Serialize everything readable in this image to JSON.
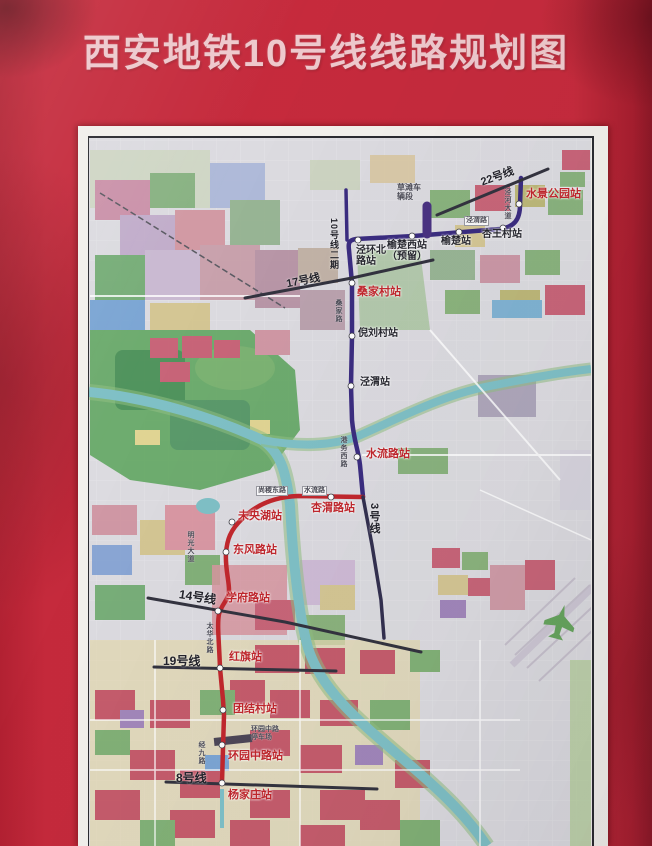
{
  "poster": {
    "title": "西安地铁10号线线路规划图"
  },
  "map": {
    "title": "西安市地铁十号线一期工程（杨家庄～水景公园）线路平面示意图",
    "colors": {
      "line10_north": "#3b2c80",
      "line10_south": "#c1272d",
      "other_lines": "#33333f",
      "station_label_red": "#c1272d",
      "station_label_black": "#26262e",
      "river": "#7fc0c6",
      "poster_background": "#c52a3c"
    },
    "lines": [
      {
        "id": "line10-north",
        "label": "10号线一期北段",
        "color": "#3b2c80",
        "width": 4.5,
        "d": "M521,178 L520,205 C520,220 514,227 500,229 L414,236 L356,239 C349,240 348,243 349,250 L352,283 L352,336 L351,386 L352,420 C354,442 358,448 360,465 L363,497"
      },
      {
        "id": "line10-phase2",
        "label": "10号线二期",
        "color": "#3b2c80",
        "width": 3.5,
        "d": "M346,190 L347,240"
      },
      {
        "id": "depot-spur",
        "label": "车辆段出入线",
        "color": "#4a3382",
        "width": 9,
        "d": "M427,206 L427,234"
      },
      {
        "id": "line10-south",
        "label": "10号线一期南段",
        "color": "#c1272d",
        "width": 4.5,
        "d": "M363,497 L298,496 C272,497 255,506 243,518 C230,530 227,540 226,553 C225,568 229,580 229,590 C229,600 222,603 219,614 C217,625 219,640 220,668 L223,700 L224,715 L223,748 L222,783"
      },
      {
        "id": "line-22",
        "label": "22号线",
        "color": "#33333f",
        "width": 3,
        "d": "M437,215 L548,169"
      },
      {
        "id": "line-17",
        "label": "17号线",
        "color": "#33333f",
        "width": 3,
        "d": "M245,298 L352,278 L433,260"
      },
      {
        "id": "line-3",
        "label": "3号线",
        "color": "#33304f",
        "width": 3.5,
        "d": "M363,497 L372,545 L381,600 L384,638"
      },
      {
        "id": "line-14",
        "label": "14号线",
        "color": "#33333f",
        "width": 3,
        "d": "M148,598 L285,622 L421,652"
      },
      {
        "id": "line-19",
        "label": "19号线",
        "color": "#33333f",
        "width": 3,
        "d": "M154,667 L336,671"
      },
      {
        "id": "line-8",
        "label": "8号线",
        "color": "#33333f",
        "width": 3,
        "d": "M166,782 L377,789"
      }
    ],
    "stations": [
      {
        "name": "水景公园站",
        "x": 519,
        "y": 204,
        "lx": 526,
        "ly": 189,
        "color": "red"
      },
      {
        "name": "杏王村站",
        "x": 503,
        "y": 228,
        "lx": 482,
        "ly": 230,
        "color": "black"
      },
      {
        "name": "榆楚站",
        "x": 459,
        "y": 232,
        "lx": 441,
        "ly": 237,
        "color": "black"
      },
      {
        "name": "榆楚西站（预留）",
        "lines": [
          "榆楚西站",
          "（预留）"
        ],
        "x": 412,
        "y": 236,
        "lx": 387,
        "ly": 241,
        "color": "black"
      },
      {
        "name": "泾环北路站",
        "lines": [
          "泾环北",
          "路站"
        ],
        "x": 358,
        "y": 240,
        "lx": 356,
        "ly": 246,
        "color": "black"
      },
      {
        "name": "桑家村站",
        "x": 352,
        "y": 283,
        "lx": 357,
        "ly": 287,
        "color": "red"
      },
      {
        "name": "倪刘村站",
        "x": 352,
        "y": 336,
        "lx": 358,
        "ly": 329,
        "color": "black"
      },
      {
        "name": "泾渭站",
        "x": 351,
        "y": 386,
        "lx": 360,
        "ly": 378,
        "color": "black"
      },
      {
        "name": "水流路站",
        "x": 357,
        "y": 457,
        "lx": 366,
        "ly": 449,
        "color": "red"
      },
      {
        "name": "杏渭路站",
        "x": 331,
        "y": 497,
        "lx": 311,
        "ly": 503,
        "color": "red"
      },
      {
        "name": "未央湖站",
        "x": 232,
        "y": 522,
        "lx": 238,
        "ly": 511,
        "color": "red"
      },
      {
        "name": "东风路站",
        "x": 226,
        "y": 552,
        "lx": 233,
        "ly": 545,
        "color": "red"
      },
      {
        "name": "学府路站",
        "x": 218,
        "y": 611,
        "lx": 226,
        "ly": 593,
        "color": "red"
      },
      {
        "name": "红旗站",
        "x": 220,
        "y": 668,
        "lx": 229,
        "ly": 652,
        "color": "red"
      },
      {
        "name": "团结村站",
        "x": 223,
        "y": 710,
        "lx": 233,
        "ly": 704,
        "color": "red"
      },
      {
        "name": "环园中路站",
        "x": 222,
        "y": 745,
        "lx": 228,
        "ly": 751,
        "color": "red"
      },
      {
        "name": "杨家庄站",
        "x": 222,
        "y": 783,
        "lx": 228,
        "ly": 790,
        "color": "red"
      }
    ],
    "line_labels": [
      {
        "text": "22号线",
        "x": 480,
        "y": 168,
        "rot": -20,
        "size": 11
      },
      {
        "text": "10号线二期",
        "x": 328,
        "y": 218,
        "vertical": true,
        "size": 9
      },
      {
        "text": "17号线",
        "x": 286,
        "y": 272,
        "rot": -11,
        "size": 11
      },
      {
        "text": "3号线",
        "x": 366,
        "y": 503,
        "vertical": true,
        "size": 11
      },
      {
        "text": "14号线",
        "x": 179,
        "y": 588,
        "rot": 9,
        "size": 12
      },
      {
        "text": "19号线",
        "x": 163,
        "y": 652,
        "rot": 0,
        "size": 12
      },
      {
        "text": "8号线",
        "x": 176,
        "y": 769,
        "rot": 0,
        "size": 12
      }
    ],
    "road_labels": [
      {
        "lines": [
          "草滩车",
          "辆段"
        ],
        "x": 397,
        "y": 183,
        "size": 8
      },
      {
        "text": "泾河大道",
        "x": 503,
        "y": 188,
        "vertical": true,
        "size": 7
      },
      {
        "text": "泾渭路",
        "x": 464,
        "y": 216,
        "boxed": true,
        "size": 7
      },
      {
        "text": "桑家路",
        "x": 334,
        "y": 299,
        "vertical": true,
        "size": 7
      },
      {
        "text": "港务西路",
        "x": 339,
        "y": 436,
        "vertical": true,
        "size": 7
      },
      {
        "text": "尚稷东路",
        "x": 256,
        "y": 486,
        "boxed": true,
        "size": 7
      },
      {
        "text": "水流路",
        "x": 302,
        "y": 486,
        "boxed": true,
        "size": 7
      },
      {
        "text": "明光大道",
        "x": 186,
        "y": 531,
        "vertical": true,
        "size": 7
      },
      {
        "text": "太华北路",
        "x": 205,
        "y": 622,
        "vertical": true,
        "size": 7
      },
      {
        "text": "经九路",
        "x": 197,
        "y": 741,
        "vertical": true,
        "size": 7
      },
      {
        "lines": [
          "环园中路",
          "停车场"
        ],
        "x": 251,
        "y": 726,
        "size": 7
      }
    ]
  }
}
